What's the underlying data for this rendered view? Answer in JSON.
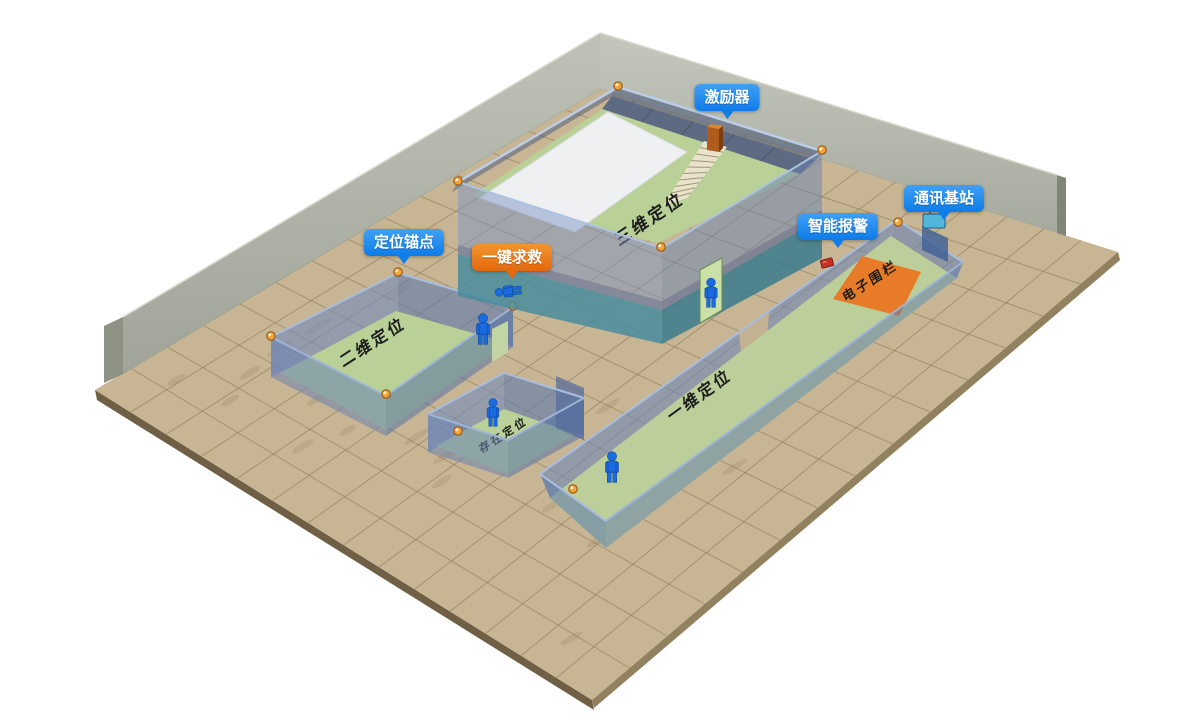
{
  "labels": {
    "exciter": "激励器",
    "comm_station": "通讯基站",
    "smart_alarm": "智能报警",
    "anchor_point": "定位锚点",
    "sos": "一键求救"
  },
  "zones": {
    "three_d": "三维定位",
    "two_d": "二维定位",
    "presence": "存在定位",
    "one_d": "一维定位",
    "fence": "电子围栏"
  },
  "colors": {
    "label_blue": "#1e88f0",
    "label_orange": "#ed7a1c",
    "floor_tan": "#c7b593",
    "zone_green": "#b9d197",
    "wall_blue": "#7e96bf",
    "wall_teal": "#4f8fa0",
    "back_wall_gray": "#a7aa9d",
    "fence_orange": "#e87b28",
    "person_blue": "#1a6ae0",
    "anchor_orange": "#f2a53c",
    "stairs_cream": "#e9e3cb"
  }
}
